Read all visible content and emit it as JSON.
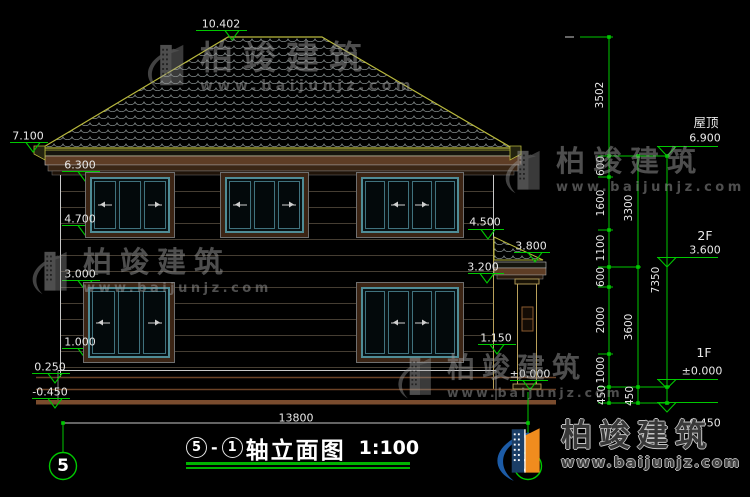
{
  "watermark": {
    "brand": "柏竣建筑",
    "url": "www.baijunjz.com"
  },
  "logo": {
    "brand": "柏竣建筑",
    "url": "www.baijunjz.com"
  },
  "title": {
    "axis_start": "5",
    "separator": "-",
    "axis_end": "1",
    "name": "轴立面图",
    "scale": "1:100"
  },
  "axis_bubbles": {
    "left": "5",
    "right": "1"
  },
  "floor_levels": {
    "roof_label": "屋顶",
    "roof_level": "6.900",
    "f2_label": "2F",
    "f2_level": "3.600",
    "f1_label": "1F",
    "f1_level": "±0.000",
    "right_ground": "-0.450"
  },
  "marks": {
    "ridge": "10.402",
    "left_eave": "7.100",
    "f2_window_head": "6.300",
    "f2_window_sill": "4.700",
    "f1_window_head": "3.000",
    "f1_window_sill": "1.000",
    "plinth_top": "0.250",
    "left_ground": "-0.450",
    "porch_roof_top": "4.500",
    "porch_eave": "3.800",
    "porch_beam": "3.200",
    "porch_sill": "1.150",
    "porch_ground": "±0.000"
  },
  "dimensions": {
    "total_width": "13800",
    "chain_inner": [
      "3502",
      "600",
      "1600",
      "1100",
      "600",
      "2000",
      "1000",
      "450"
    ],
    "chain_middle": [
      "3300",
      "3600",
      "450"
    ],
    "chain_outer": "7350"
  },
  "colors": {
    "dim_green": "#00c800",
    "roof_edge": "#b9b93d",
    "window_teal": "#4f8c96",
    "trim_brown": "#5a3a22",
    "logo_blue": "#1c5ba6",
    "logo_orange": "#f08c1e"
  }
}
